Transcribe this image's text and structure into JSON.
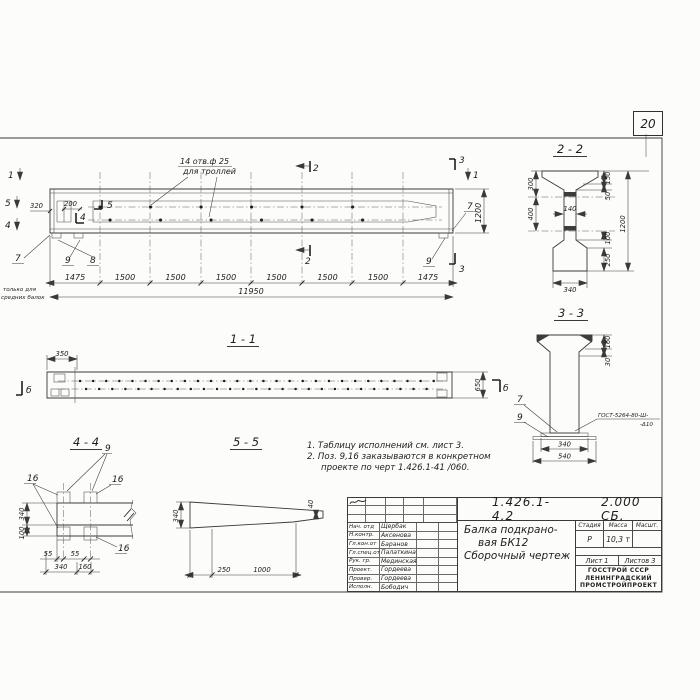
{
  "page": {
    "sheet_number": "20"
  },
  "main_view": {
    "hole_note_1": "14 отв.ф 25",
    "hole_note_2": "для троллей",
    "only_note_1": "только для",
    "only_note_2": "средних балок",
    "dim_320": "320",
    "dim_200": "200",
    "mark_1": "1",
    "mark_2": "2",
    "mark_3": "3",
    "mark_4": "4",
    "mark_5": "5",
    "pos_7": "7",
    "pos_8": "8",
    "pos_9": "9",
    "dim_1200": "1200",
    "chain": [
      "1475",
      "1500",
      "1500",
      "1500",
      "1500",
      "1500",
      "1500",
      "1475"
    ],
    "dim_total": "11950"
  },
  "section_2_2": {
    "title": "2 - 2",
    "dim_300": "300",
    "dim_400": "400",
    "dim_150": "150",
    "dim_50": "50",
    "dim_1200": "1200",
    "dim_100": "100",
    "dim_250": "250",
    "dim_140": "140",
    "dim_340": "340"
  },
  "section_3_3": {
    "title": "3 - 3",
    "dim_160": "160",
    "dim_30": "30",
    "dim_340": "340",
    "dim_540": "540",
    "pos_7": "7",
    "pos_9": "9",
    "weld_1": "ГОСТ-5264-80-Ш-",
    "weld_2": "-Δ10",
    "mark_b": "б"
  },
  "section_1_1": {
    "title": "1 - 1",
    "dim_350": "350",
    "dim_650": "650",
    "mark_b": "б"
  },
  "section_4_4": {
    "title": "4 - 4",
    "pos_9": "9",
    "pos_16": "16",
    "dim_340v": "340",
    "dim_100": "100",
    "dim_55": "55",
    "dim_340": "340",
    "dim_160": "160"
  },
  "section_5_5": {
    "title": "5 - 5",
    "dim_340": "340",
    "dim_40": "40",
    "dim_250": "250",
    "dim_1000": "1000"
  },
  "notes": {
    "line_1": "1. Таблицу исполнений см. лист 3.",
    "line_2": "2. Поз. 9,16 заказываются в конкретном",
    "line_3": "проекте по черт 1.426.1-41 /060."
  },
  "title_block": {
    "doc_number": "1.426.1-4.2",
    "doc_code": "2.000 СБ.",
    "name_1": "Балка подкрано-",
    "name_2": "вая  БК12",
    "name_3": "Сборочный  чертеж",
    "stage_label": "Стадия",
    "mass_label": "Масса",
    "scale_label": "Масшт.",
    "stage": "Р",
    "mass": "10,3 т",
    "scale": "",
    "sheet": "Лист 1",
    "sheets": "Листов 3",
    "org_1": "ГОССТРОЙ СССР",
    "org_2": "ЛЕНИНГРАДСКИЙ",
    "org_3": "ПРОМСТРОЙПРОЕКТ",
    "signatures": [
      {
        "role": "Нач. отд",
        "name": "Щербак"
      },
      {
        "role": "Н.контр.",
        "name": "Аксенова"
      },
      {
        "role": "Гл.кон.от",
        "name": "Баранов"
      },
      {
        "role": "Гл.спец.от",
        "name": "Палаткина"
      },
      {
        "role": "Рук. гр.",
        "name": "Мединская"
      },
      {
        "role": "Проект.",
        "name": "Гордеева"
      },
      {
        "role": "Провер.",
        "name": "Гордеева"
      },
      {
        "role": "Исполн.",
        "name": "Бободич"
      }
    ]
  }
}
